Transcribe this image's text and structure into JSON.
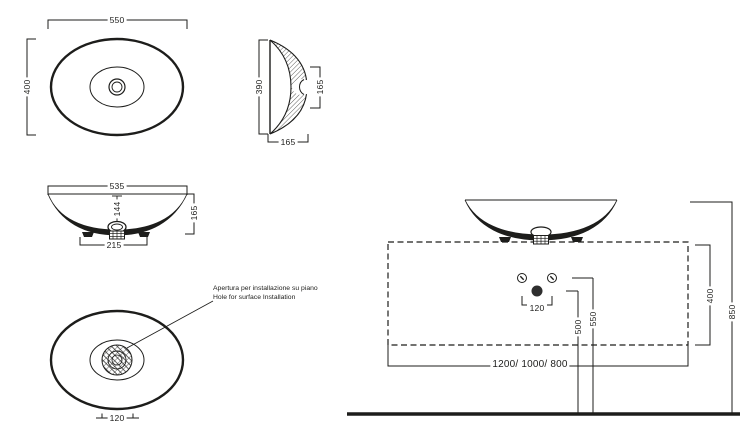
{
  "title": "Countertop washbasin technical drawing",
  "colors": {
    "line": "#1d1d1b",
    "background": "#ffffff",
    "drain_dot": "#2e2e2e"
  },
  "views": {
    "top": {
      "width": "550",
      "depth": "400"
    },
    "side_section": {
      "width": "390",
      "bowl_inner_height": "165",
      "height": "165"
    },
    "front": {
      "width": "535",
      "inner_depth": "144",
      "height": "165",
      "base_width": "215"
    },
    "bottom": {
      "drain_diameter": "120",
      "note_it": "Apertura per installazione su piano",
      "note_en": "Hole for surface Installation"
    },
    "installation": {
      "tap_holes_spacing": "120",
      "drain_height": "500",
      "tap_height": "550",
      "counter_depth": "400",
      "rim_height": "850",
      "counter_widths": "1200/ 1000/ 800"
    }
  }
}
